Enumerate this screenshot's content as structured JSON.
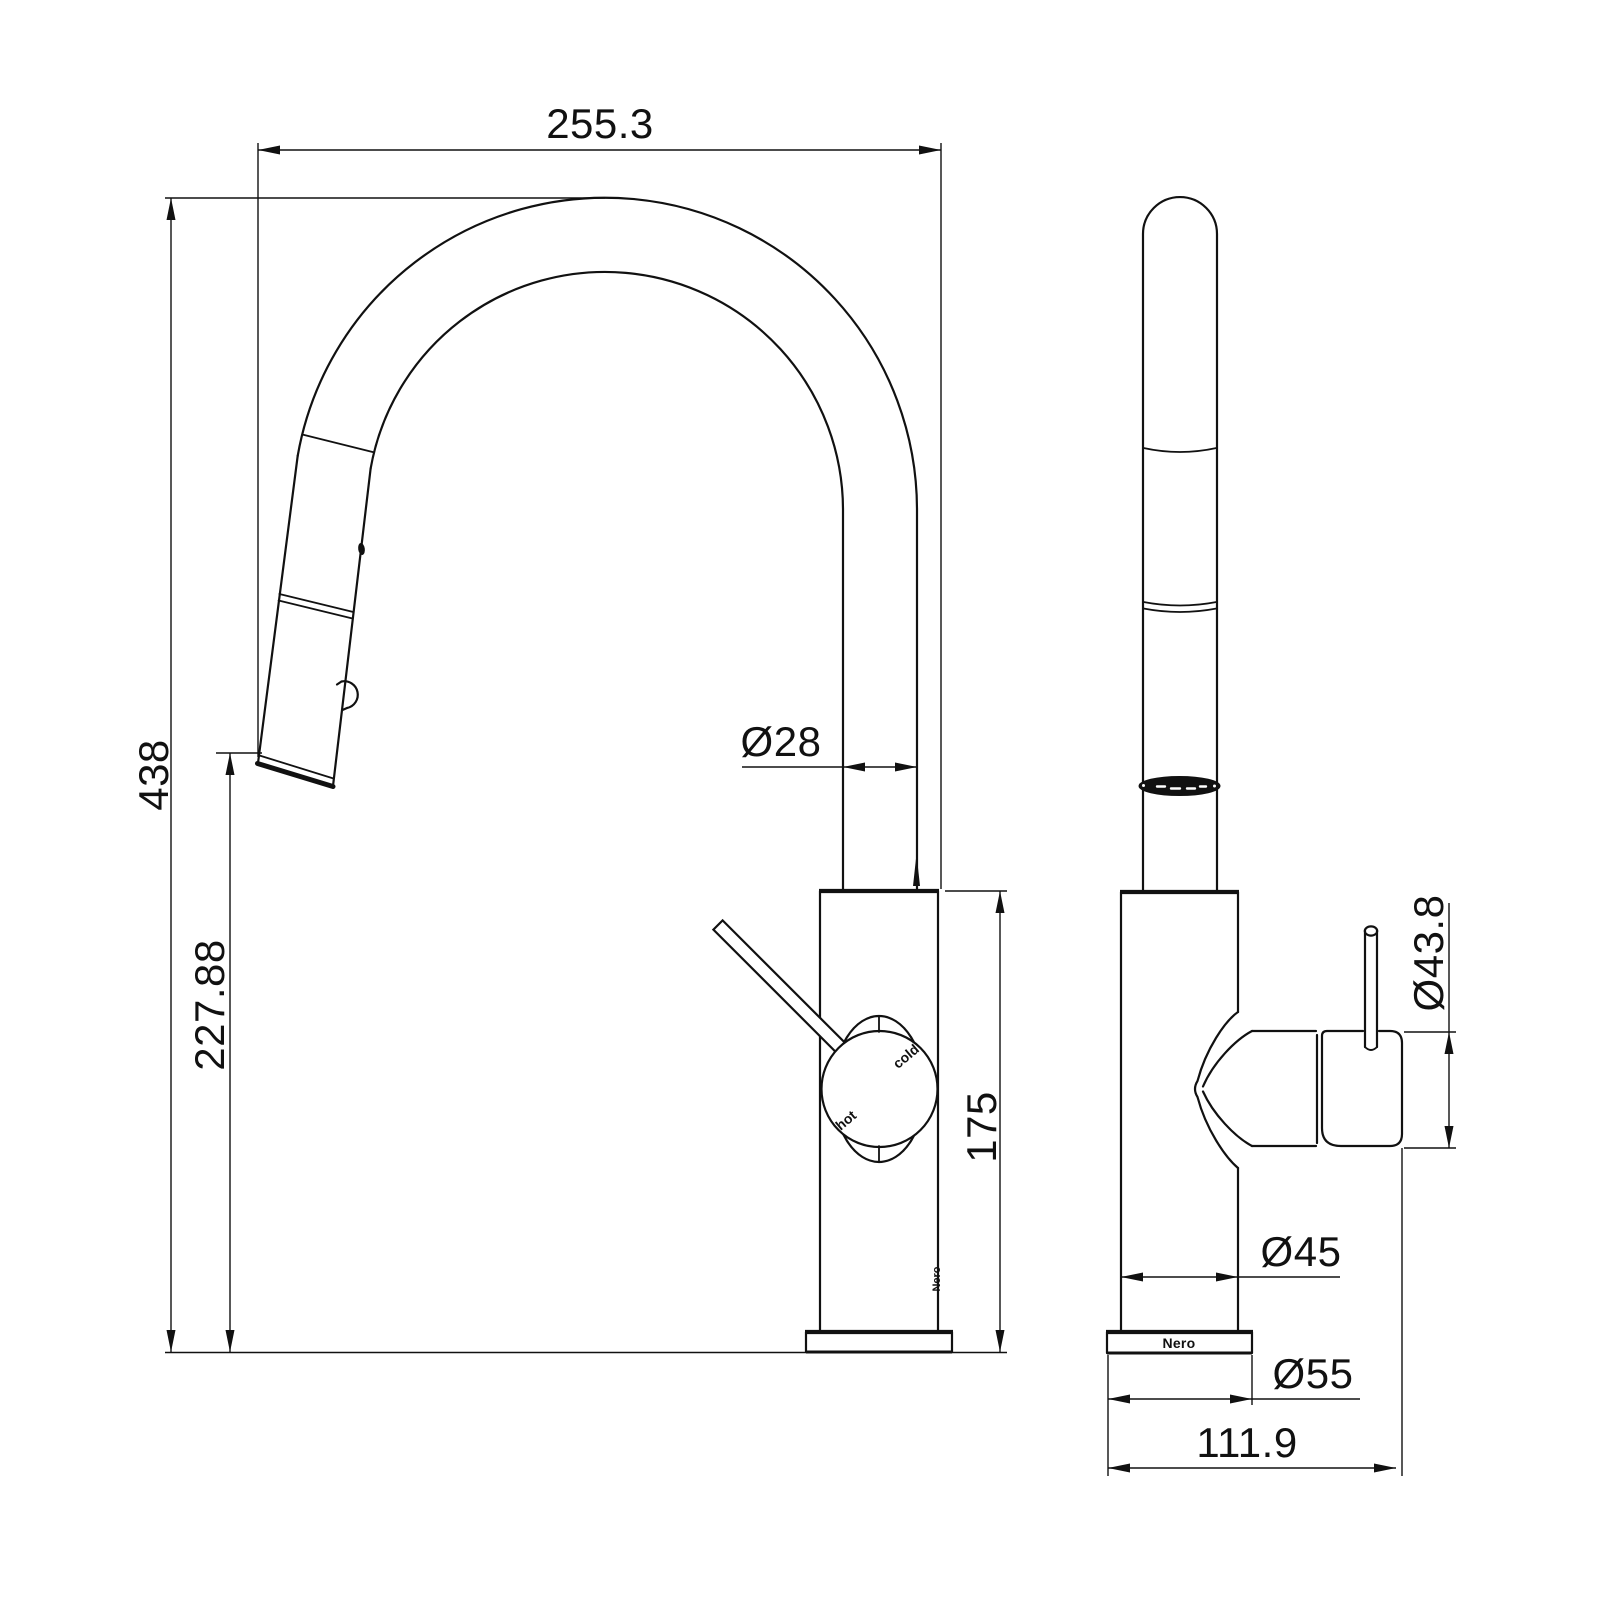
{
  "drawing": {
    "title": "kitchen-mixer-tap-dimension-drawing",
    "background": "#ffffff",
    "line_color": "#111111",
    "views": {
      "front": "front-view-gooseneck-pull-out-mixer",
      "side": "side-view-mixer"
    },
    "dimensions": {
      "overall_reach": "255.3",
      "overall_height": "438",
      "outlet_height": "227.88",
      "spout_diameter": "Ø28",
      "body_height": "175",
      "handle_diameter": "Ø43.8",
      "body_diameter": "Ø45",
      "base_diameter": "Ø55",
      "overall_depth": "111.9"
    },
    "labels": {
      "hot": "hot",
      "cold": "cold",
      "brand_base": "Nero",
      "brand_side": "Nero"
    }
  }
}
